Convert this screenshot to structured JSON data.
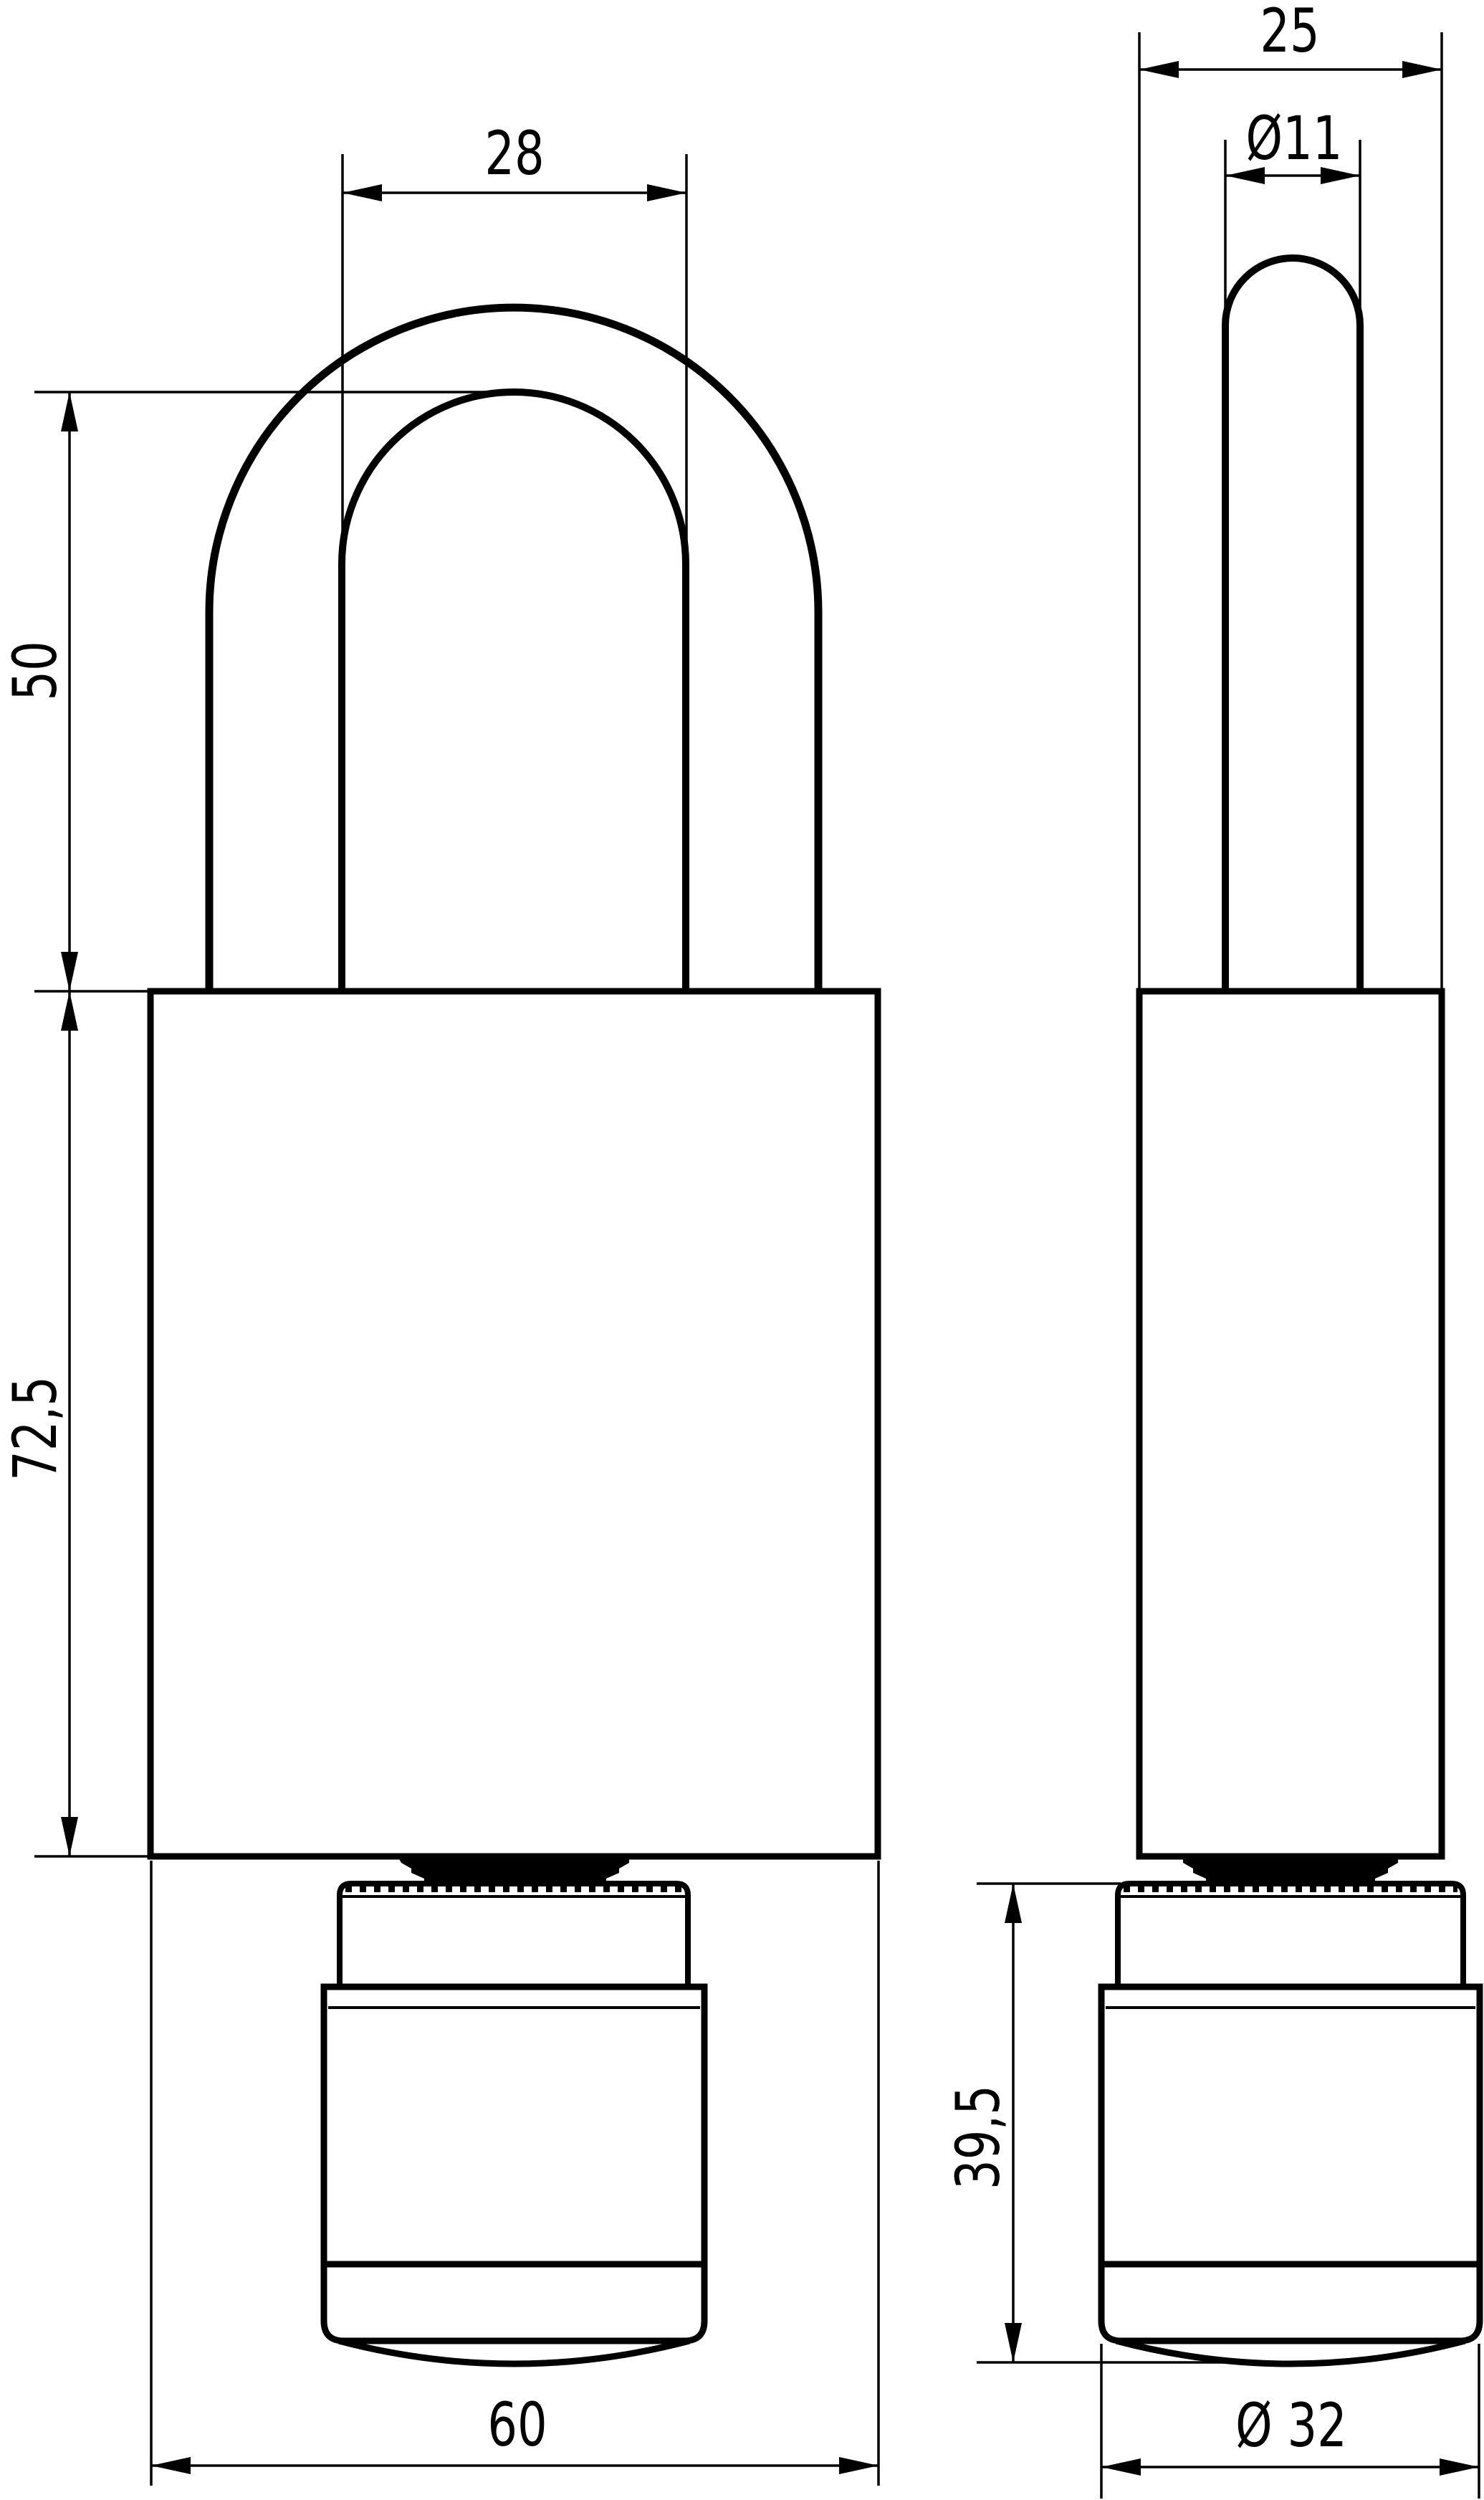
{
  "drawing": {
    "kind": "padlock dimensional drawing",
    "colors": {
      "line": "#000000",
      "background": "#ffffff"
    }
  },
  "dims": {
    "shackle_inner_width": "28",
    "shackle_height": "50",
    "body_height": "72,5",
    "body_width": "60",
    "body_depth": "25",
    "shackle_diameter": "Ø11",
    "cylinder_height": "39,5",
    "cylinder_diameter": "Ø 32"
  }
}
